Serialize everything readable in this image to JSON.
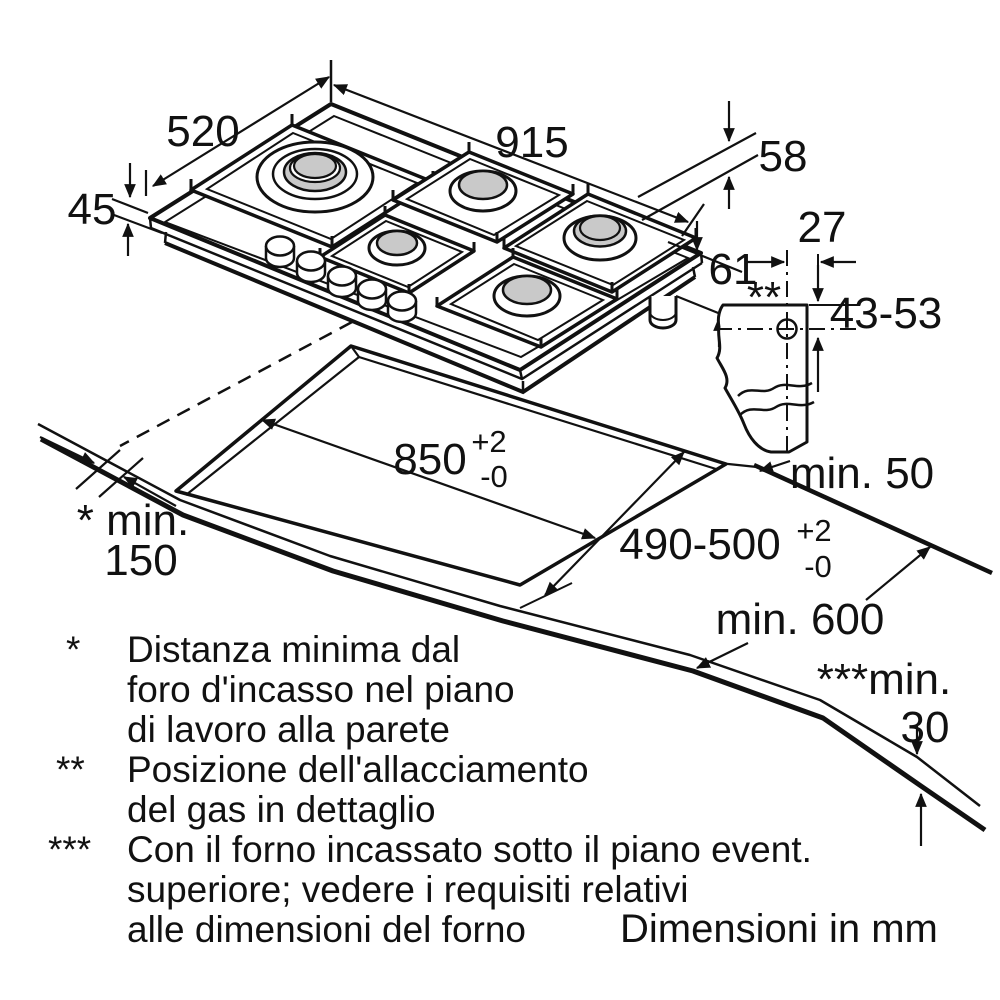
{
  "units_note": "Dimensioni in mm",
  "dimensions": {
    "hob_depth": "520",
    "hob_width": "915",
    "hob_height": "45",
    "hob_total_height": "58",
    "install_clearance": "61",
    "gas_conn_horizontal": "27",
    "gas_conn_vertical": "43-53",
    "gas_conn_marker": "**",
    "cutout_width": "850",
    "cutout_width_tol_up": "+2",
    "cutout_width_tol_down": "-0",
    "cutout_depth": "490-500",
    "cutout_depth_tol_up": "+2",
    "cutout_depth_tol_down": "-0",
    "min_rear_clearance": "min. 50",
    "min_worktop_depth": "min. 600",
    "min_wall_line1": "* min.",
    "min_wall_line2": "150",
    "min_below_line1": "***min.",
    "min_below_line2": "30"
  },
  "footnotes": [
    {
      "marker": "*",
      "lines": [
        "Distanza minima dal",
        "foro d'incasso nel piano",
        "di lavoro alla parete"
      ]
    },
    {
      "marker": "**",
      "lines": [
        "Posizione dell'allacciamento",
        "del gas in dettaglio"
      ]
    },
    {
      "marker": "***",
      "lines": [
        "Con il forno incassato sotto il piano event.",
        "superiore; vedere i requisiti relativi",
        "alle dimensioni del forno"
      ]
    }
  ],
  "colors": {
    "line": "#111111",
    "burner_cap": "#c9c9c9",
    "background": "#ffffff"
  }
}
